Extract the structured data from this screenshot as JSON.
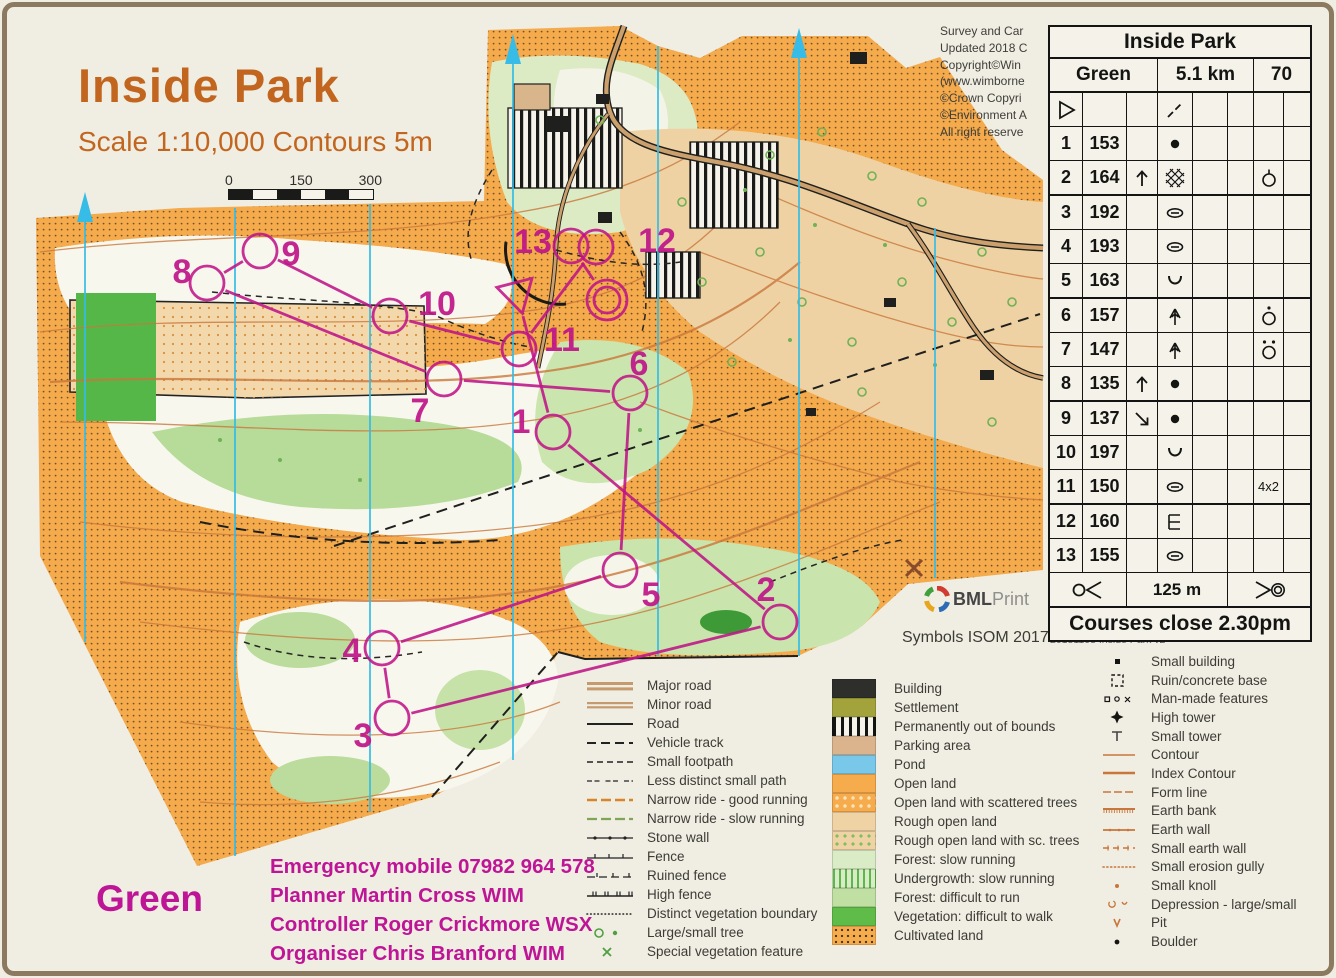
{
  "page": {
    "title": "Inside Park",
    "subtitle": "Scale 1:10,000 Contours 5m",
    "course_label": "Green",
    "symbols_note": "Symbols ISOM 2017",
    "print_credit": [
      "www.condes.net 9.7.16 BML Printers Ltd",
      "20181108 Inside Park v2"
    ],
    "printer_logo": {
      "bold": "BML",
      "light": "Print"
    }
  },
  "copyright_lines": [
    "Survey and Car",
    "Updated 2018 C",
    "Copyright©Win",
    "(www.wimborne",
    "©Crown Copyri",
    "©Environment A",
    "All right reserve"
  ],
  "scale_bar": {
    "labels": [
      "0",
      "150",
      "300"
    ]
  },
  "credits": {
    "emergency": "Emergency mobile  07982 964 578",
    "planner": "Planner Martin Cross WIM",
    "controller": "Controller Roger Crickmore WSX",
    "organiser": "Organiser Chris Branford WIM"
  },
  "control_card": {
    "title": "Inside Park",
    "course": "Green",
    "length": "5.1 km",
    "climb": "70",
    "start_row": {
      "a": "start-tri",
      "d": "slash"
    },
    "rows": [
      {
        "n": "1",
        "code": "153",
        "c": "",
        "d": "dot",
        "g": ""
      },
      {
        "n": "2",
        "code": "164",
        "c": "arrow-up",
        "d": "stony",
        "g": "circle-tick"
      },
      {
        "n": "3",
        "code": "192",
        "c": "",
        "d": "depression",
        "g": ""
      },
      {
        "n": "4",
        "code": "193",
        "c": "",
        "d": "depression",
        "g": ""
      },
      {
        "n": "5",
        "code": "163",
        "c": "",
        "d": "reentrant",
        "g": ""
      },
      {
        "n": "6",
        "code": "157",
        "c": "",
        "d": "tree",
        "g": "circle-dot"
      },
      {
        "n": "7",
        "code": "147",
        "c": "",
        "d": "tree",
        "g": "circle-2dot"
      },
      {
        "n": "8",
        "code": "135",
        "c": "arrow-up",
        "d": "dot",
        "g": ""
      },
      {
        "n": "9",
        "code": "137",
        "c": "arrow-se",
        "d": "dot",
        "g": ""
      },
      {
        "n": "10",
        "code": "197",
        "c": "",
        "d": "reentrant",
        "g": ""
      },
      {
        "n": "11",
        "code": "150",
        "c": "",
        "d": "depression",
        "g": "4x2"
      },
      {
        "n": "12",
        "code": "160",
        "c": "",
        "d": "ruin",
        "g": ""
      },
      {
        "n": "13",
        "code": "155",
        "c": "",
        "d": "depression",
        "g": ""
      }
    ],
    "footer": {
      "left": "fin-tape",
      "distance": "125 m",
      "right": "fin-dbl"
    },
    "closing": "Courses close 2.30pm"
  },
  "course": {
    "color": "#BF1588",
    "start": {
      "x": 517,
      "y": 293
    },
    "finish": {
      "x": 607,
      "y": 300
    },
    "sequence": [
      "start",
      "1",
      "2",
      "3",
      "4",
      "5",
      "6",
      "7",
      "8",
      "9",
      "10",
      "11",
      "12",
      "13",
      "finish"
    ],
    "controls": [
      {
        "n": "1",
        "x": 553,
        "y": 432,
        "lx": 521,
        "ly": 421
      },
      {
        "n": "2",
        "x": 780,
        "y": 622,
        "lx": 766,
        "ly": 589
      },
      {
        "n": "3",
        "x": 392,
        "y": 718,
        "lx": 363,
        "ly": 735
      },
      {
        "n": "4",
        "x": 382,
        "y": 648,
        "lx": 352,
        "ly": 650
      },
      {
        "n": "5",
        "x": 620,
        "y": 570,
        "lx": 651,
        "ly": 594
      },
      {
        "n": "6",
        "x": 630,
        "y": 393,
        "lx": 639,
        "ly": 363
      },
      {
        "n": "7",
        "x": 444,
        "y": 379,
        "lx": 420,
        "ly": 410
      },
      {
        "n": "8",
        "x": 207,
        "y": 283,
        "lx": 182,
        "ly": 271
      },
      {
        "n": "9",
        "x": 260,
        "y": 251,
        "lx": 291,
        "ly": 253
      },
      {
        "n": "10",
        "x": 390,
        "y": 316,
        "lx": 437,
        "ly": 303
      },
      {
        "n": "11",
        "x": 519,
        "y": 349,
        "lx": 562,
        "ly": 339
      },
      {
        "n": "12",
        "x": 596,
        "y": 247,
        "lx": 657,
        "ly": 240
      },
      {
        "n": "13",
        "x": 571,
        "y": 246,
        "lx": 533,
        "ly": 241
      }
    ]
  },
  "legend": {
    "lines": [
      {
        "s": "major-road",
        "t": "Major road"
      },
      {
        "s": "minor-road",
        "t": "Minor road"
      },
      {
        "s": "road",
        "t": "Road"
      },
      {
        "s": "vehicle-track",
        "t": "Vehicle track"
      },
      {
        "s": "small-footpath",
        "t": "Small footpath"
      },
      {
        "s": "less-distinct",
        "t": "Less distinct small path"
      },
      {
        "s": "ride-good",
        "t": "Narrow ride - good running"
      },
      {
        "s": "ride-slow",
        "t": "Narrow ride - slow running"
      },
      {
        "s": "stone-wall",
        "t": "Stone wall"
      },
      {
        "s": "fence",
        "t": "Fence"
      },
      {
        "s": "ruined-fence",
        "t": "Ruined fence"
      },
      {
        "s": "high-fence",
        "t": "High fence"
      },
      {
        "s": "veg-boundary",
        "t": "Distinct vegetation boundary"
      },
      {
        "s": "trees",
        "t": "Large/small tree"
      },
      {
        "s": "special-veg",
        "t": "Special vegetation feature"
      }
    ],
    "areas": [
      {
        "s": "sw-building",
        "t": "Building"
      },
      {
        "s": "sw-settlement",
        "t": "Settlement"
      },
      {
        "s": "sw-oob",
        "t": "Permanently out of bounds"
      },
      {
        "s": "sw-parking",
        "t": "Parking area"
      },
      {
        "s": "sw-pond",
        "t": "Pond"
      },
      {
        "s": "sw-open",
        "t": "Open land"
      },
      {
        "s": "sw-open-sc",
        "t": "Open land with scattered trees"
      },
      {
        "s": "sw-rough",
        "t": "Rough open land"
      },
      {
        "s": "sw-rough-sc",
        "t": "Rough open land with sc. trees"
      },
      {
        "s": "sw-forest-slow",
        "t": "Forest: slow running"
      },
      {
        "s": "sw-undergrowth",
        "t": "Undergrowth: slow running"
      },
      {
        "s": "sw-forest-diff",
        "t": "Forest: difficult to run"
      },
      {
        "s": "sw-veg-diff",
        "t": "Vegetation: difficult to walk"
      },
      {
        "s": "sw-cultivated",
        "t": "Cultivated land"
      }
    ],
    "points": [
      {
        "s": "small-building",
        "t": "Small building"
      },
      {
        "s": "ruin-base",
        "t": "Ruin/concrete base"
      },
      {
        "s": "man-made",
        "t": "Man-made features"
      },
      {
        "s": "high-tower",
        "t": "High tower"
      },
      {
        "s": "small-tower",
        "t": "Small tower"
      },
      {
        "s": "contour",
        "t": "Contour"
      },
      {
        "s": "index-contour",
        "t": "Index Contour"
      },
      {
        "s": "form-line",
        "t": "Form line"
      },
      {
        "s": "earth-bank",
        "t": "Earth bank"
      },
      {
        "s": "earth-wall",
        "t": "Earth wall"
      },
      {
        "s": "small-earth-wall",
        "t": "Small earth wall"
      },
      {
        "s": "erosion-gully",
        "t": "Small erosion gully"
      },
      {
        "s": "small-knoll",
        "t": "Small knoll"
      },
      {
        "s": "depression-ls",
        "t": "Depression - large/small"
      },
      {
        "s": "pit",
        "t": "Pit"
      },
      {
        "s": "boulder",
        "t": "Boulder"
      }
    ]
  }
}
